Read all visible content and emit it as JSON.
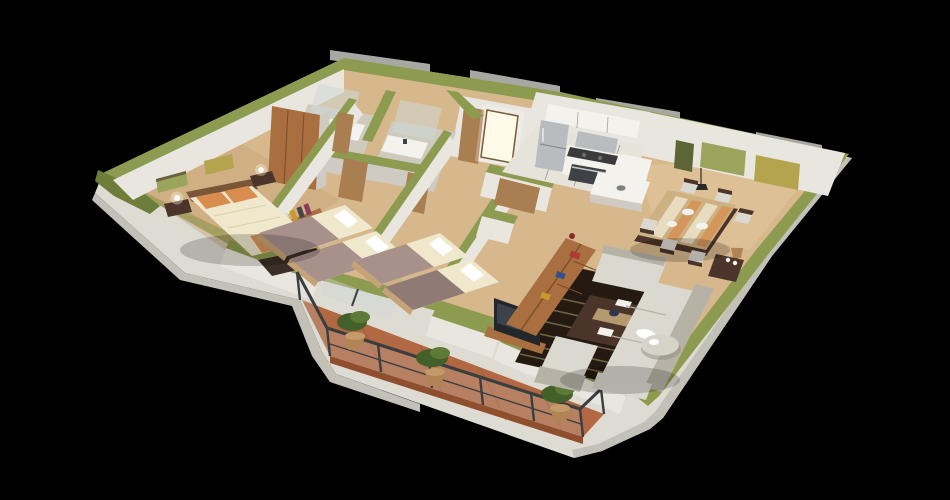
{
  "scene": {
    "description": "3D isometric cutaway floor-plan render of an apartment with olive-green wall caps on a black background",
    "style": "architectural-3d-render"
  },
  "colors": {
    "background": "#000000",
    "greenCap": "#8c9b50",
    "greenCapLight": "#a6b266",
    "greenCapDark": "#6e7d3a",
    "wallWhite": "#e9e6df",
    "wallLight": "#f4f2ec",
    "wallShade": "#cfcbc2",
    "wallDark": "#b4b0a6",
    "grayBack": "#a9a7a1",
    "shell": "#dedbd3",
    "shellShade": "#c3c0b7",
    "wood": "#d7b88c",
    "woodShade": "#c5a377",
    "woodLight": "#e3c89e",
    "kitchenFloor": "#e6e3db",
    "bathFloor": "#cfcabe",
    "terracotta": "#b26843",
    "terracottaDark": "#8f4f2e",
    "rug": "#241a11",
    "rugStripe": "#887c58",
    "sofa": "#dbd8cf",
    "sofaShade": "#b6b2a6",
    "tableWood": "#cdb182",
    "darkWood": "#4b352a",
    "furnWood": "#aa6f40",
    "doorWood": "#a97e50",
    "steel": "#b9bcbe",
    "steelDark": "#7c8083",
    "appliance": "#3f4244",
    "glass": "#cdd8d6",
    "railing": "#3a3e3f",
    "plant": "#5d7a36",
    "plantDark": "#43602a",
    "pot": "#b08455",
    "sheet": "#f0e8cc",
    "blanket": "#a8918b",
    "blanketDark": "#8f7a74",
    "pillowOrange": "#d88c4e",
    "glow": "#fffbe8",
    "blueBowl": "#2c3650",
    "paint1": "#9aa45c",
    "paint2": "#b4a44e",
    "paint3": "#5d6435"
  },
  "rooms": [
    {
      "name": "master-bedroom",
      "furniture": [
        "double-bed",
        "orange-pillows",
        "foot-bench",
        "nightstand-left",
        "nightstand-right",
        "table-lamp-left",
        "table-lamp-right",
        "wardrobe",
        "wall-picture-1",
        "wall-picture-2",
        "book-shelf"
      ]
    },
    {
      "name": "bathroom-1",
      "furniture": [
        "vanity-counter",
        "faucet",
        "shower-glass",
        "wood-door"
      ]
    },
    {
      "name": "bathroom-2",
      "furniture": [
        "vanity-counter",
        "faucet",
        "shower-glass",
        "wood-door"
      ]
    },
    {
      "name": "entry",
      "furniture": [
        "glowing-front-door",
        "closet-panel"
      ]
    },
    {
      "name": "kitchen",
      "furniture": [
        "fridge",
        "range-hood",
        "cooktop",
        "oven",
        "upper-cabinets",
        "counter",
        "sink-peninsula",
        "tile-floor"
      ]
    },
    {
      "name": "dining-room",
      "furniture": [
        "dining-table",
        "table-runner",
        "place-settings",
        "chairs-x6",
        "pendant-lamp",
        "sideboard",
        "wall-painting-1",
        "wall-painting-2",
        "small-wall-picture"
      ]
    },
    {
      "name": "living-room",
      "furniture": [
        "striped-dark-rug",
        "sectional-sofa",
        "chaise",
        "armchair",
        "round-side-table",
        "coffee-table",
        "blue-bowl",
        "tv-screen",
        "bookshelf",
        "basket",
        "floor-lamp"
      ]
    },
    {
      "name": "bedroom-2",
      "furniture": [
        "single-bed-1",
        "single-bed-2",
        "desk",
        "laptop",
        "desk-lamp"
      ]
    },
    {
      "name": "bedroom-3",
      "furniture": [
        "single-bed-1",
        "single-bed-2"
      ]
    },
    {
      "name": "hallway",
      "furniture": [
        "wood-doors"
      ]
    },
    {
      "name": "balcony",
      "furniture": [
        "terracotta-floor",
        "metal-glass-railing",
        "potted-plant-1",
        "potted-plant-2",
        "potted-plant-3"
      ]
    }
  ]
}
